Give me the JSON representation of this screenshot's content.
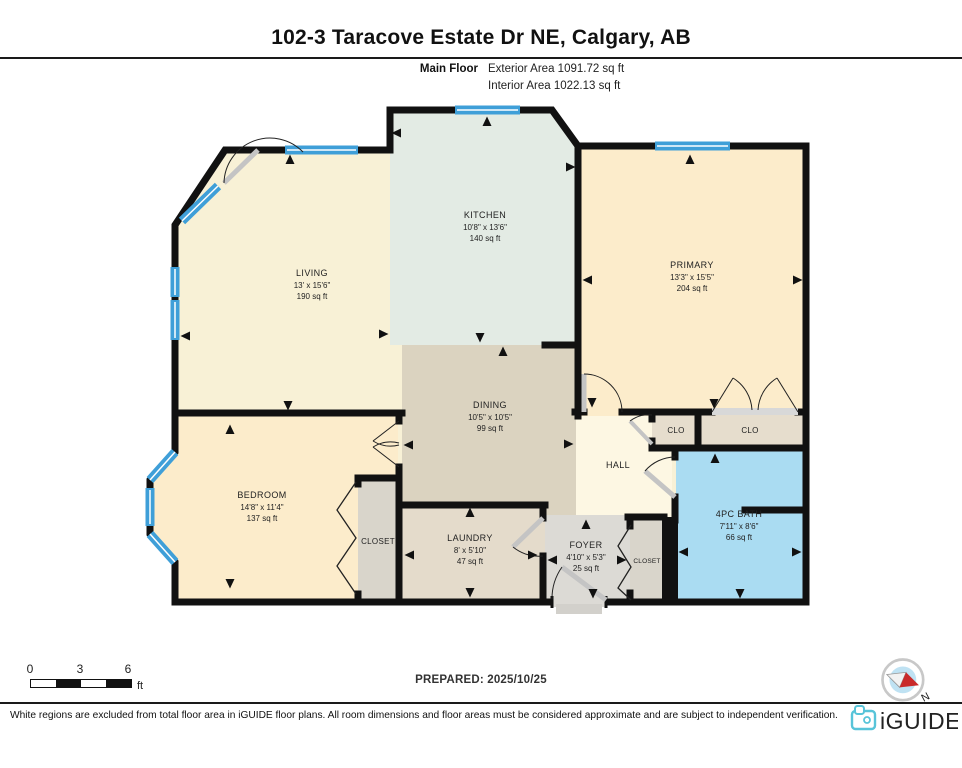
{
  "header": {
    "title": "102-3 Taracove Estate Dr NE, Calgary, AB",
    "floor_label": "Main Floor",
    "exterior_area": "Exterior Area 1091.72 sq ft",
    "interior_area": "Interior Area 1022.13 sq ft"
  },
  "rooms": {
    "kitchen": {
      "name": "KITCHEN",
      "dims": "10'8\" x 13'6\"",
      "area": "140 sq ft"
    },
    "living": {
      "name": "LIVING",
      "dims": "13' x 15'6\"",
      "area": "190 sq ft"
    },
    "primary": {
      "name": "PRIMARY",
      "dims": "13'3\" x 15'5\"",
      "area": "204 sq ft"
    },
    "dining": {
      "name": "DINING",
      "dims": "10'5\" x 10'5\"",
      "area": "99 sq ft"
    },
    "bedroom": {
      "name": "BEDROOM",
      "dims": "14'8\" x 11'4\"",
      "area": "137 sq ft"
    },
    "laundry": {
      "name": "LAUNDRY",
      "dims": "8' x 5'10\"",
      "area": "47 sq ft"
    },
    "foyer": {
      "name": "FOYER",
      "dims": "4'10\" x 5'3\"",
      "area": "25 sq ft"
    },
    "bath": {
      "name": "4PC BATH",
      "dims": "7'11\" x 8'6\"",
      "area": "66 sq ft"
    },
    "hall": {
      "name": "HALL"
    },
    "clo1": {
      "name": "CLO"
    },
    "clo2": {
      "name": "CLO"
    },
    "closet_bedroom": {
      "name": "CLOSET"
    },
    "closet_foyer": {
      "name": "CLOSET"
    }
  },
  "scale_bar": {
    "tick0": "0",
    "tick3": "3",
    "tick6": "6",
    "unit": "ft"
  },
  "prepared": "PREPARED: 2025/10/25",
  "compass": {
    "label": "N"
  },
  "footer": {
    "disclaimer": "White regions are excluded from total floor area in iGUIDE floor plans. All room dimensions and floor areas must be considered approximate and are subject to independent verification.",
    "brand": "iGUIDE"
  },
  "colors": {
    "wall": "#111111",
    "window_blue": "#3f9fd8",
    "bath_blue": "#aadcf2",
    "brand_teal": "#58c4d9"
  }
}
